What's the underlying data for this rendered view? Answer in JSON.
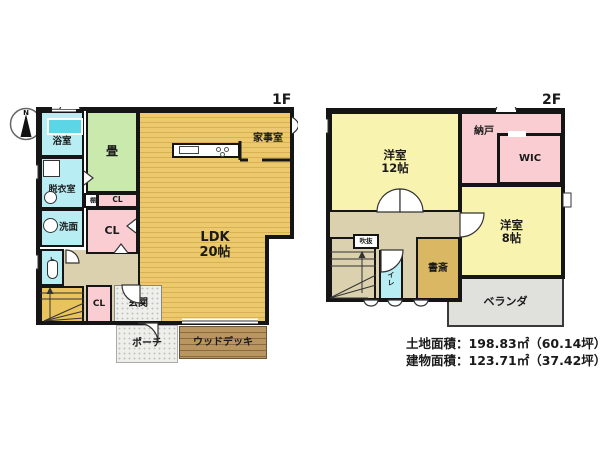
{
  "compass": {
    "label": "N"
  },
  "floor1": {
    "label": "1F",
    "rooms": {
      "bathroom": "浴室",
      "dressing_room": "脱衣室",
      "washroom": "洗面",
      "toilet": "トイレ",
      "tatami": "畳",
      "shelf": "棚",
      "closet_upper": "CL",
      "closet_middle": "CL",
      "closet_lower": "CL",
      "ldk_name": "LDK",
      "ldk_size": "20帖",
      "utility_room": "家事室",
      "entrance": "玄関",
      "porch": "ポーチ",
      "wood_deck": "ウッドデッキ"
    }
  },
  "floor2": {
    "label": "2F",
    "rooms": {
      "western_room_12_name": "洋室",
      "western_room_12_size": "12帖",
      "storage": "納戸",
      "wic": "WIC",
      "western_room_8_name": "洋室",
      "western_room_8_size": "8帖",
      "void": "吹抜",
      "toilet": "トイレ",
      "study": "書斎",
      "veranda": "ベランダ"
    }
  },
  "area_info": {
    "land": "土地面積：198.83㎡（60.14坪）",
    "building": "建物面積：123.71㎡（37.42坪）"
  },
  "colors": {
    "wall": "#151515",
    "water_rooms": "#b9edf4",
    "bathtub": "#5cd6e7",
    "tatami_room": "#c9e9ad",
    "closet": "#f9cdd2",
    "ldk_floor": "#e5c266",
    "hall": "#dbd1ae",
    "western_room": "#f9f3b0",
    "study": "#d9b763",
    "stairs_1f": "#e9c35e",
    "porch": "#eeeeea",
    "wood_deck": "#b08a54",
    "veranda": "#e0e0dc"
  }
}
